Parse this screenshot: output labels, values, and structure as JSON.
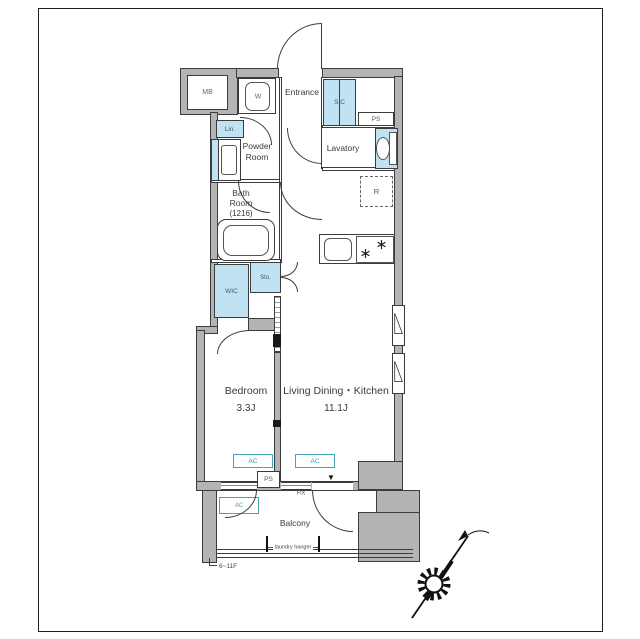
{
  "plan_title": "apartment-floor-plan",
  "colors": {
    "closet_fill": "#bfe3f3",
    "ac_accent": "#44a3b7",
    "wall_gray": "#b4b4b4",
    "line": "#3c3c3c"
  },
  "labels": {
    "mb": "MB",
    "washer": "W",
    "entrance": "Entrance",
    "sic": "SIC",
    "ps_top": "PS",
    "lin": "Lin.",
    "powder_room_line1": "Powder",
    "powder_room_line2": "Room",
    "lavatory": "Lavatory",
    "fridge": "R",
    "bath_line1": "Bath",
    "bath_line2": "Room",
    "bath_line3": "(1216)",
    "storage": "Sto.",
    "wic": "WIC",
    "bedroom_name": "Bedroom",
    "bedroom_size": "3.3J",
    "ldk_name": "Living Dining・Kitchen",
    "ldk_size": "11.1J",
    "ac_bedroom": "AC",
    "ac_living": "AC",
    "ac_outdoor": "AC",
    "ps_bottom": "PS",
    "fix": "FIX",
    "direction_marker": "▼",
    "balcony": "Balcony",
    "laundry_hanger": "laundry hanger",
    "floor_range": "6~11F"
  }
}
